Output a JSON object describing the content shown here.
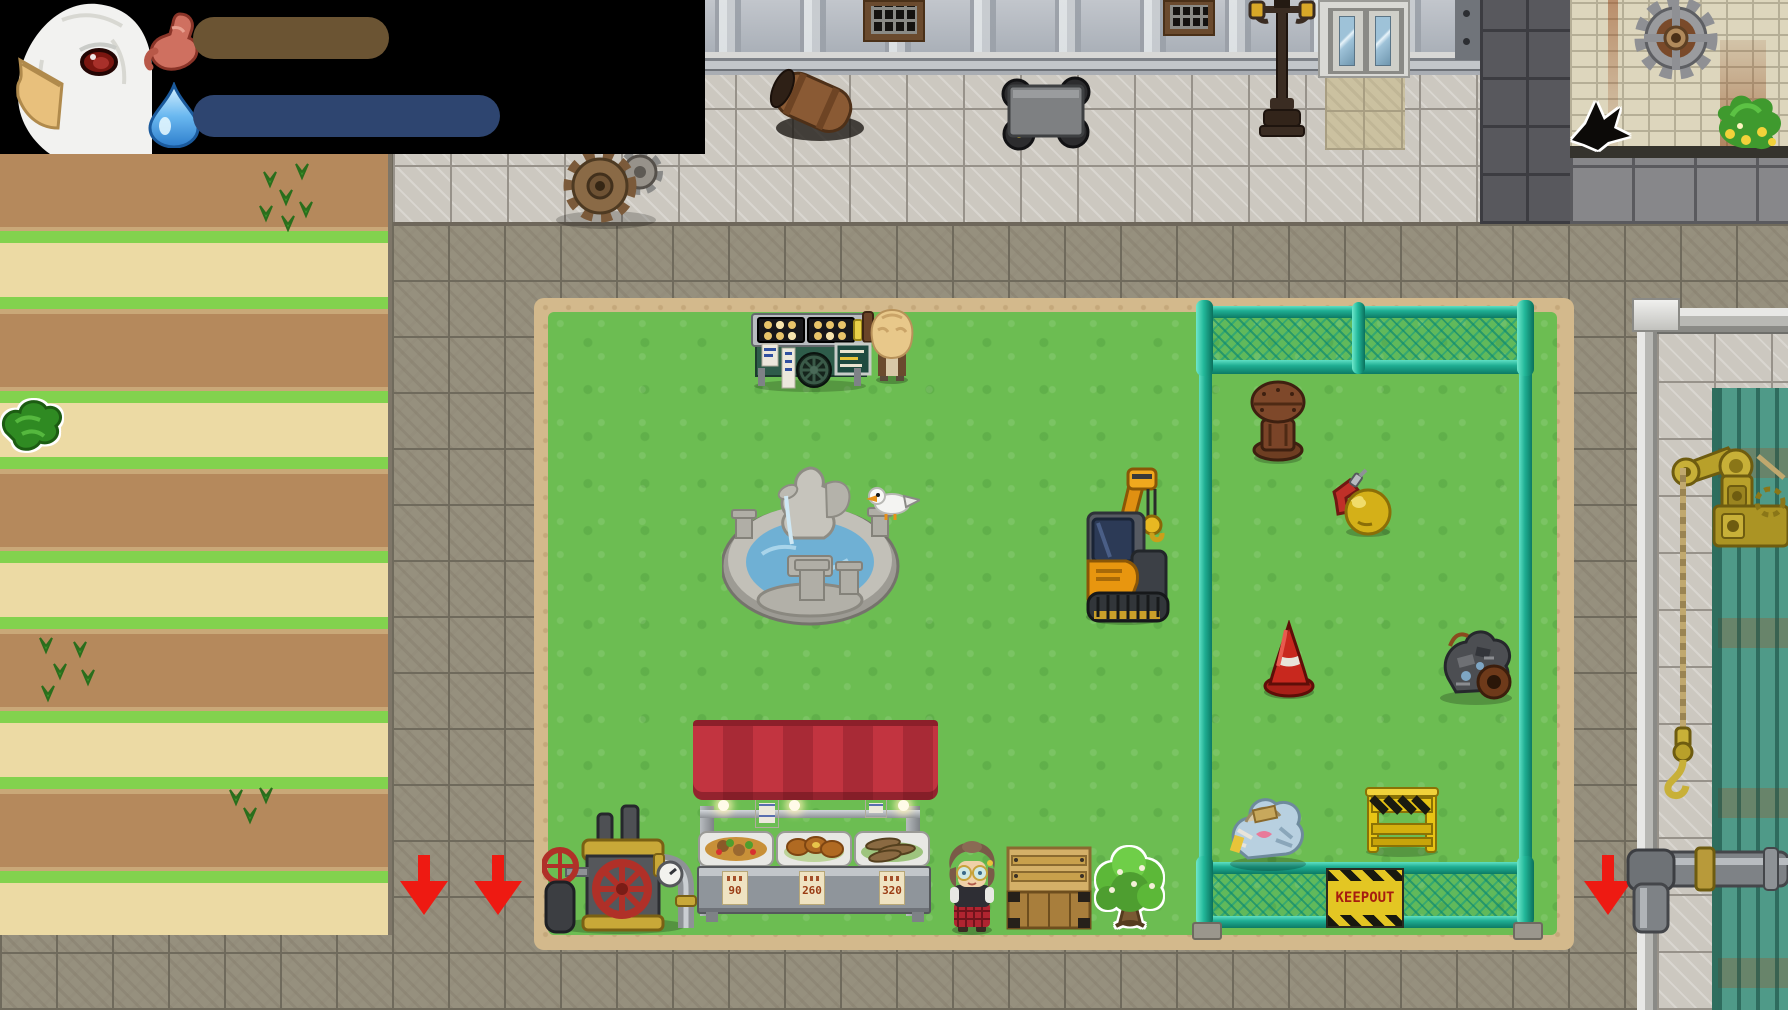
{
  "hud": {
    "portrait": "white-bird-character",
    "hunger": {
      "label": "hunger",
      "icon": "stomach-icon",
      "fill_pct": 64,
      "fill_color": "#6b5433"
    },
    "thirst": {
      "label": "thirst",
      "icon": "water-drop-icon",
      "fill_pct": 100,
      "fill_color": "#2e4570"
    }
  },
  "park": {
    "keepout_sign": "KEEPOUT",
    "stall": {
      "prices": [
        "90",
        "260",
        "320"
      ]
    }
  },
  "scene": {
    "objects": [
      "takoyaki-cart",
      "vendor-npc",
      "fountain",
      "seagull",
      "crane-excavator",
      "steam-pump",
      "food-stall",
      "girl-npc",
      "wooden-crate",
      "highlighted-tree",
      "highlighted-bush",
      "wall-hole",
      "rusty-hydrant",
      "power-drill",
      "yellow-ball",
      "traffic-cone",
      "scrap-pile",
      "trash-bags",
      "barricade",
      "mine-cart",
      "fallen-barrel",
      "lamppost",
      "elevator",
      "gears",
      "wall-gear",
      "flower-vines",
      "brass-crane",
      "exit-arrows"
    ]
  },
  "colors": {
    "hud_bg": "#000000",
    "grass": "#6cbd52",
    "cobble": "#96907e",
    "fence": "#1fae93",
    "arrow": "#ee1a12",
    "awning": "#c23440",
    "keepout_bg": "#e3c623",
    "keepout_text": "#a61c10"
  }
}
